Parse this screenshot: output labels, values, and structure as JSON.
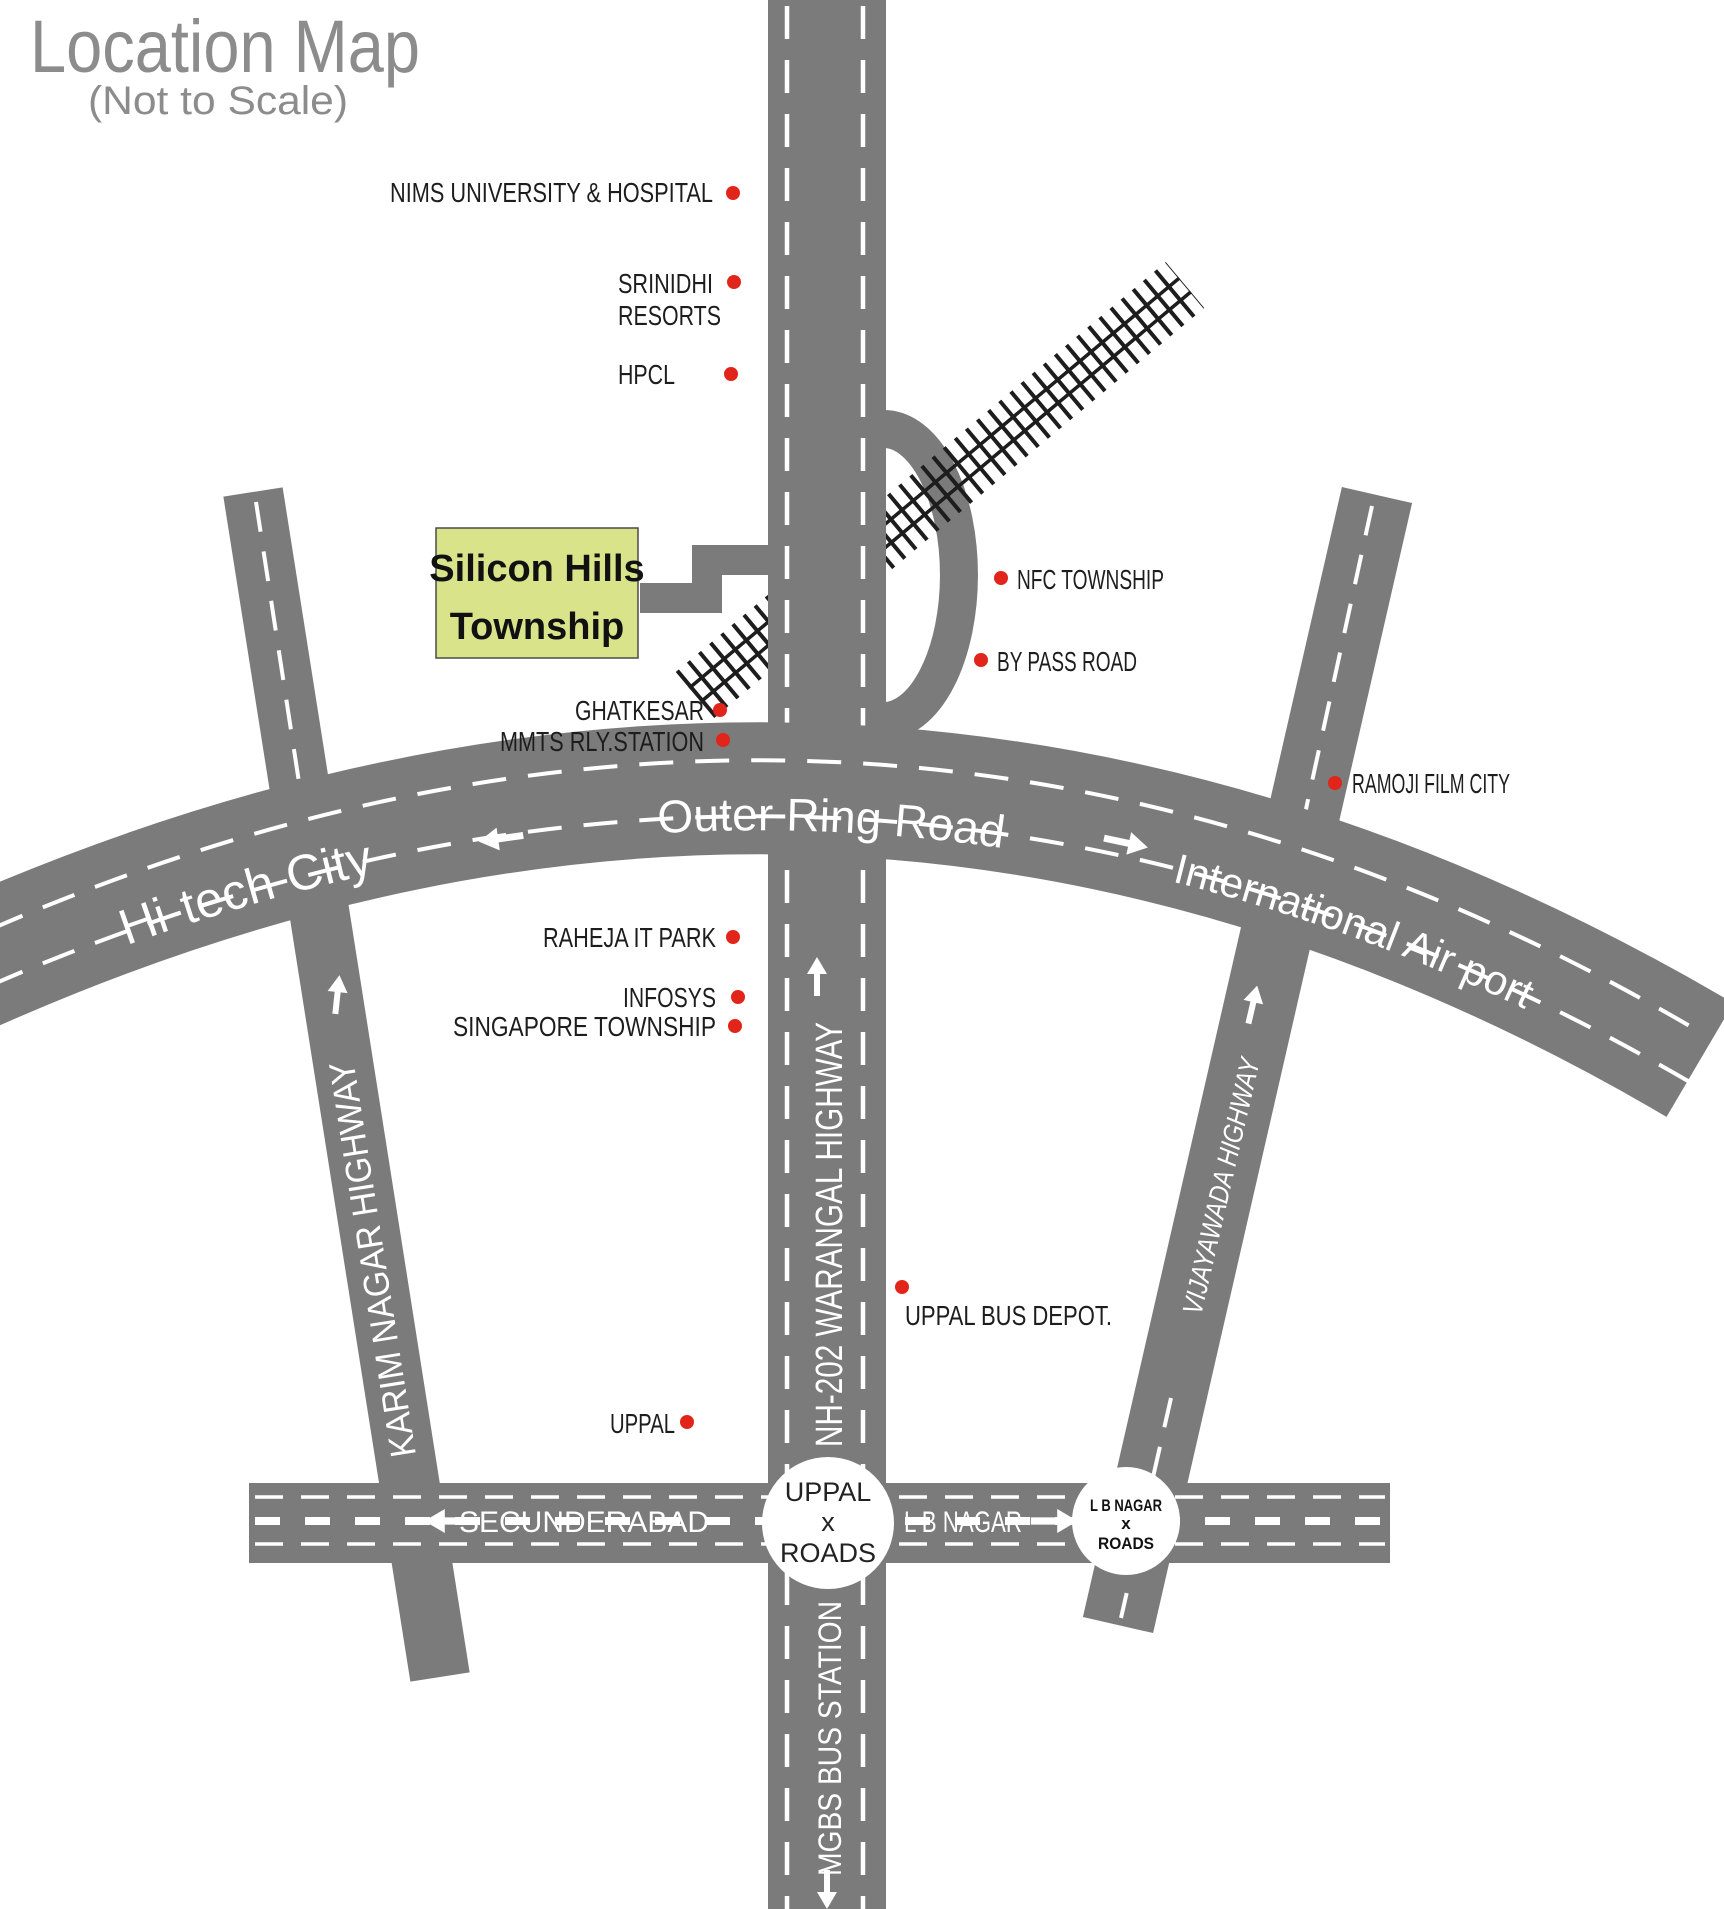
{
  "title": {
    "heading": "Location Map",
    "subtitle": "(Not to Scale)"
  },
  "township": {
    "line1": "Silicon Hills",
    "line2": "Township"
  },
  "road_labels": {
    "outer_ring": "Outer Ring Road",
    "hitech_city": "Hi-tech City",
    "international_airport": "International Air port",
    "nh202_warangal": "NH-202 WARANGAL HIGHWAY",
    "mgbs_bus_station": "MGBS BUS STATION",
    "karim_nagar": "KARIM NAGAR HIGHWAY",
    "vijayawada": "VIJAYAWADA HIGHWAY",
    "secunderabad": "SECUNDERABAD",
    "lb_nagar": "L B NAGAR"
  },
  "junctions": {
    "uppal": {
      "line1": "UPPAL",
      "line2": "x",
      "line3": "ROADS"
    },
    "lb_nagar": {
      "line1": "L B NAGAR",
      "line2": "x",
      "line3": "ROADS"
    }
  },
  "landmarks": {
    "nims": "NIMS UNIVERSITY & HOSPITAL",
    "srinidhi_line1": "SRINIDHI",
    "srinidhi_line2": "RESORTS",
    "hpcl": "HPCL",
    "nfc_township": "NFC TOWNSHIP",
    "bypass_road": "BY PASS ROAD",
    "ghatkesar": "GHATKESAR",
    "mmts": "MMTS RLY.STATION",
    "ramoji": "RAMOJI FILM CITY",
    "raheja": "RAHEJA IT PARK",
    "infosys": "INFOSYS",
    "singapore": "SINGAPORE TOWNSHIP",
    "uppal_bus_depot": "UPPAL BUS DEPOT.",
    "uppal": "UPPAL"
  },
  "colors": {
    "road": "#7b7b7b",
    "landmark_dot": "#e1251b",
    "township_fill": "#d9e48a",
    "railway": "#1d1d1d",
    "title_text": "#8c8c8c",
    "label_text": "#1d1d1d"
  }
}
